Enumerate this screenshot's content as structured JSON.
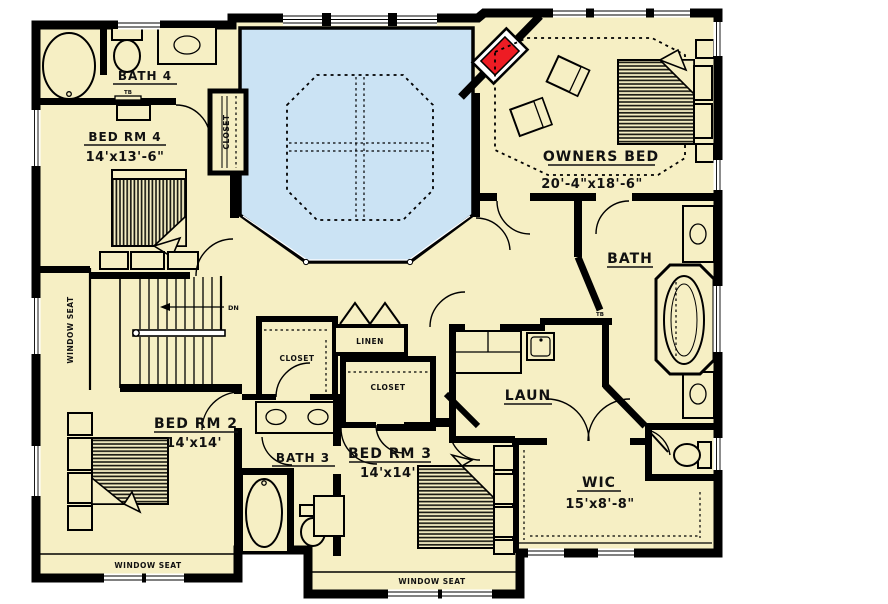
{
  "plan_type": "second-floor residential floor plan",
  "colors": {
    "floor": "#f6efc4",
    "open_to_below": "#cbe3f4",
    "wall": "#000000",
    "fireplace": "#ed1c24",
    "window": "#ffffff"
  },
  "rooms": {
    "bath4": {
      "label": "BATH 4"
    },
    "bedrm4": {
      "label": "BED RM 4",
      "dims": "14'x13'-6\""
    },
    "owners_bed": {
      "label": "OWNERS BED",
      "dims": "20'-4\"x18'-6\""
    },
    "bath": {
      "label": "BATH"
    },
    "laun": {
      "label": "LAUN"
    },
    "linen": {
      "label": "LINEN"
    },
    "wic": {
      "label": "WIC",
      "dims": "15'x8'-8\""
    },
    "bedrm2": {
      "label": "BED RM 2",
      "dims": "14'x14'"
    },
    "bath3": {
      "label": "BATH 3"
    },
    "bedrm3": {
      "label": "BED RM 3",
      "dims": "14'x14'"
    },
    "closet_bedrm4": {
      "label": "CLOSET"
    },
    "closet_hall": {
      "label": "CLOSET"
    },
    "closet_bedrm3": {
      "label": "CLOSET"
    }
  },
  "annotations": {
    "window_seat_left": "WINDOW SEAT",
    "window_seat_bedrm2": "WINDOW SEAT",
    "window_seat_bedrm3": "WINDOW SEAT",
    "stairs_down": "DN",
    "towel_bar_bath4": "TB",
    "towel_bar_hall": "TB",
    "towel_bar_bath3": "TB"
  }
}
